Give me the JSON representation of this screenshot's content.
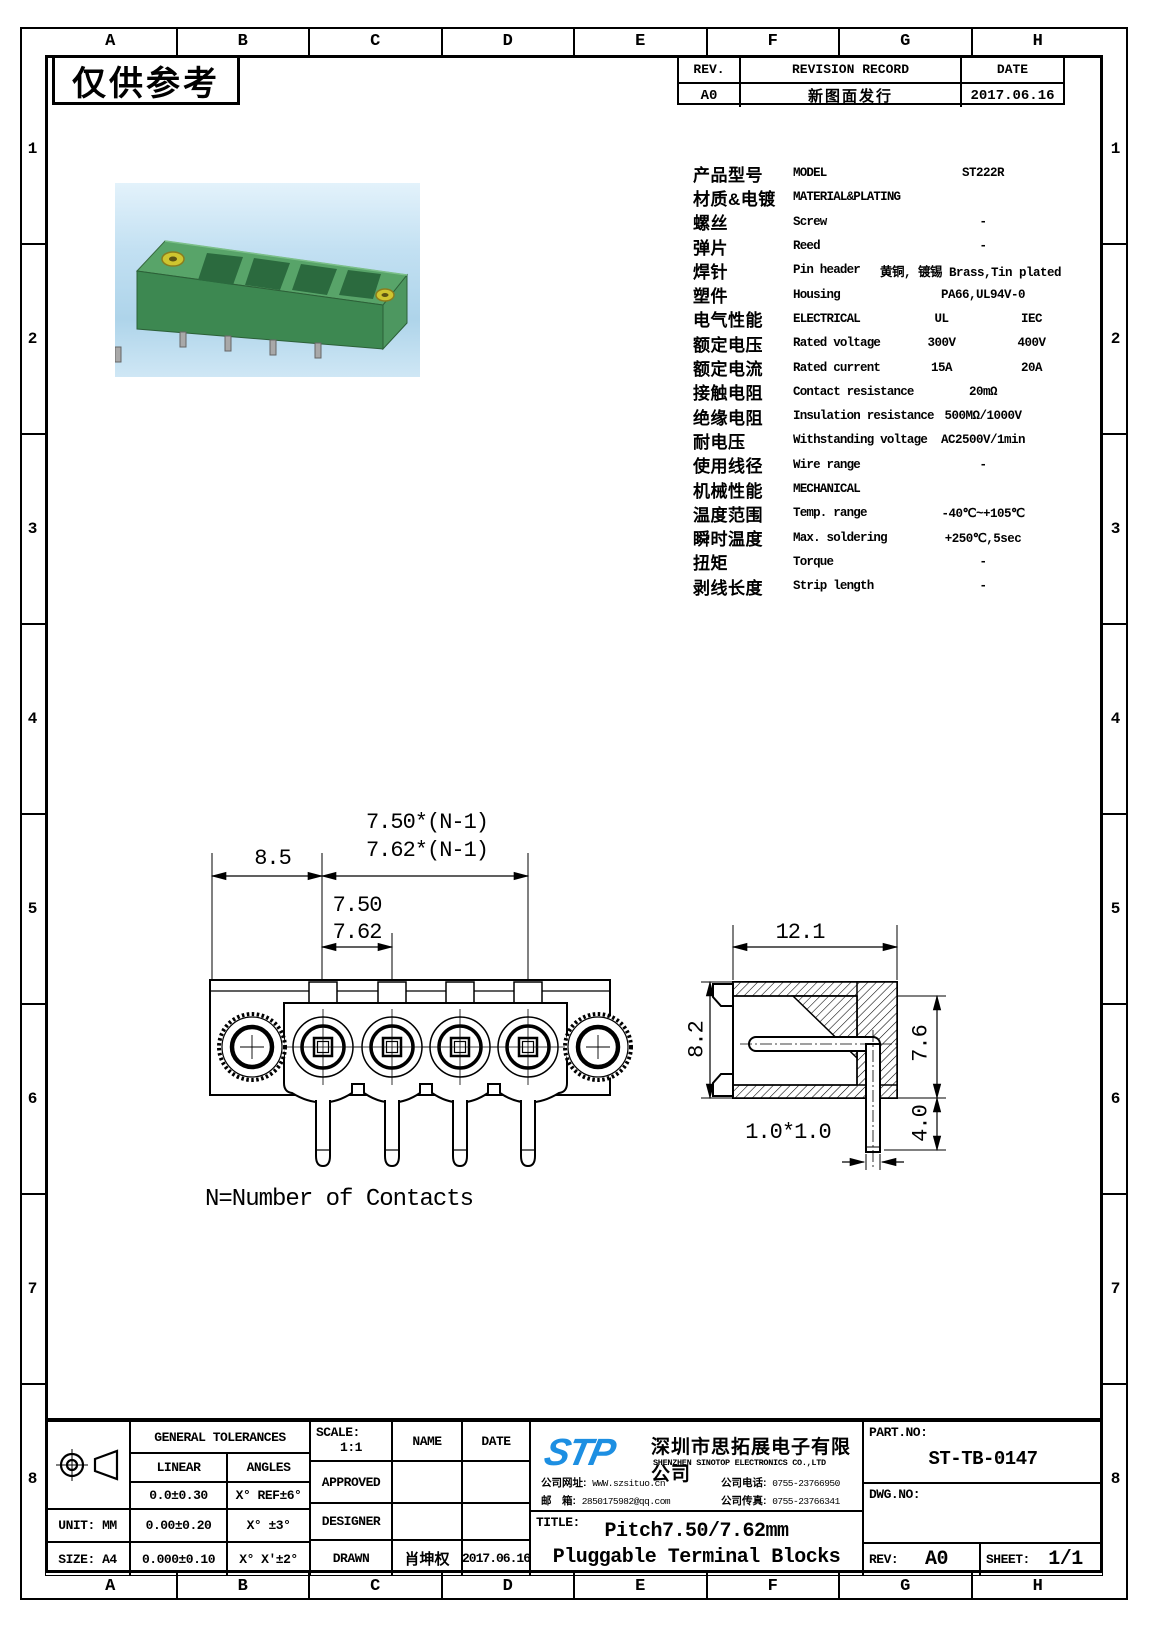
{
  "stamp": "仅供参考",
  "zones": {
    "cols": [
      "A",
      "B",
      "C",
      "D",
      "E",
      "F",
      "G",
      "H"
    ],
    "rows": [
      "1",
      "2",
      "3",
      "4",
      "5",
      "6",
      "7",
      "8"
    ]
  },
  "revision": {
    "rev_h": "REV.",
    "record_h": "REVISION RECORD",
    "date_h": "DATE",
    "rows": [
      {
        "rev": "A0",
        "record": "新图面发行",
        "date": "2017.06.16"
      }
    ]
  },
  "spec": {
    "rows": [
      {
        "zh": "产品型号",
        "en": "MODEL",
        "v1": "ST222R",
        "v2": ""
      },
      {
        "zh": "材质&电镀",
        "en": "MATERIAL&PLATING",
        "v1": "",
        "v2": ""
      },
      {
        "zh": "螺丝",
        "en": "Screw",
        "v1": "-",
        "v2": ""
      },
      {
        "zh": "弹片",
        "en": "Reed",
        "v1": "-",
        "v2": ""
      },
      {
        "zh": "焊针",
        "en": "Pin header",
        "v1": "黄铜, 镀锡 Brass,Tin plated",
        "v2": ""
      },
      {
        "zh": "塑件",
        "en": "Housing",
        "v1": "PA66,UL94V-0",
        "v2": ""
      },
      {
        "zh": "电气性能",
        "en": "ELECTRICAL",
        "v1": "UL",
        "v2": "IEC"
      },
      {
        "zh": "额定电压",
        "en": "Rated voltage",
        "v1": "300V",
        "v2": "400V"
      },
      {
        "zh": "额定电流",
        "en": "Rated current",
        "v1": "15A",
        "v2": "20A"
      },
      {
        "zh": "接触电阻",
        "en": "Contact resistance",
        "v1": "20mΩ",
        "v2": ""
      },
      {
        "zh": "绝缘电阻",
        "en": "Insulation resistance",
        "v1": "500MΩ/1000V",
        "v2": ""
      },
      {
        "zh": "耐电压",
        "en": "Withstanding voltage",
        "v1": "AC2500V/1min",
        "v2": ""
      },
      {
        "zh": "使用线径",
        "en": "Wire range",
        "v1": "-",
        "v2": ""
      },
      {
        "zh": "机械性能",
        "en": "MECHANICAL",
        "v1": "",
        "v2": ""
      },
      {
        "zh": "温度范围",
        "en": "Temp. range",
        "v1": "-40℃~+105℃",
        "v2": ""
      },
      {
        "zh": "瞬时温度",
        "en": "Max. soldering",
        "v1": "+250℃,5sec",
        "v2": ""
      },
      {
        "zh": "扭矩",
        "en": "Torque",
        "v1": "-",
        "v2": ""
      },
      {
        "zh": "剥线长度",
        "en": "Strip length",
        "v1": "-",
        "v2": ""
      }
    ]
  },
  "dims": {
    "pitch_total_1": "7.50*(N-1)",
    "pitch_total_2": "7.62*(N-1)",
    "end_margin": "8.5",
    "pitch_1": "7.50",
    "pitch_2": "7.62",
    "depth": "12.1",
    "body_height": "8.2",
    "rear_height": "7.6",
    "pin_length": "4.0",
    "pin_square": "1.0*1.0",
    "note": "N=Number of Contacts"
  },
  "company": {
    "logo": "STP",
    "name_zh": "深圳市思拓展电子有限公司",
    "name_en": "SHENZHEN SINOTOP ELECTRONICS CO.,LTD",
    "website_label": "公司网址:",
    "website": "WWW.szsituo.cn",
    "email_label": "邮　箱:",
    "email": "2850175982@qq.com",
    "phone_label": "公司电话:",
    "phone": "0755-23766950",
    "fax_label": "公司传真:",
    "fax": "0755-23766341"
  },
  "tb": {
    "general_tolerances": "GENERAL TOLERANCES",
    "linear": "LINEAR",
    "angles": "ANGLES",
    "tol_l1": "0.0±0.30",
    "tol_a1": "X° REF±6°",
    "tol_l2": "0.00±0.20",
    "tol_a2": "X° ±3°",
    "tol_l3": "0.000±0.10",
    "tol_a3": "X° X'±2°",
    "unit": "UNIT: MM",
    "size": "SIZE: A4",
    "scale_label": "SCALE:",
    "scale_value": "1:1",
    "name_h": "NAME",
    "date_h": "DATE",
    "approved": "APPROVED",
    "designer": "DESIGNER",
    "drawn": "DRAWN",
    "drawn_name": "肖坤权",
    "drawn_date": "2017.06.16",
    "title_label": "TITLE:",
    "title_line1": "Pitch7.50/7.62mm",
    "title_line2": "Pluggable Terminal Blocks",
    "part_no_label": "PART.NO:",
    "part_no": "ST-TB-0147",
    "dwg_no_label": "DWG.NO:",
    "rev_label": "REV:",
    "rev": "A0",
    "sheet_label": "SHEET:",
    "sheet": "1/1"
  }
}
